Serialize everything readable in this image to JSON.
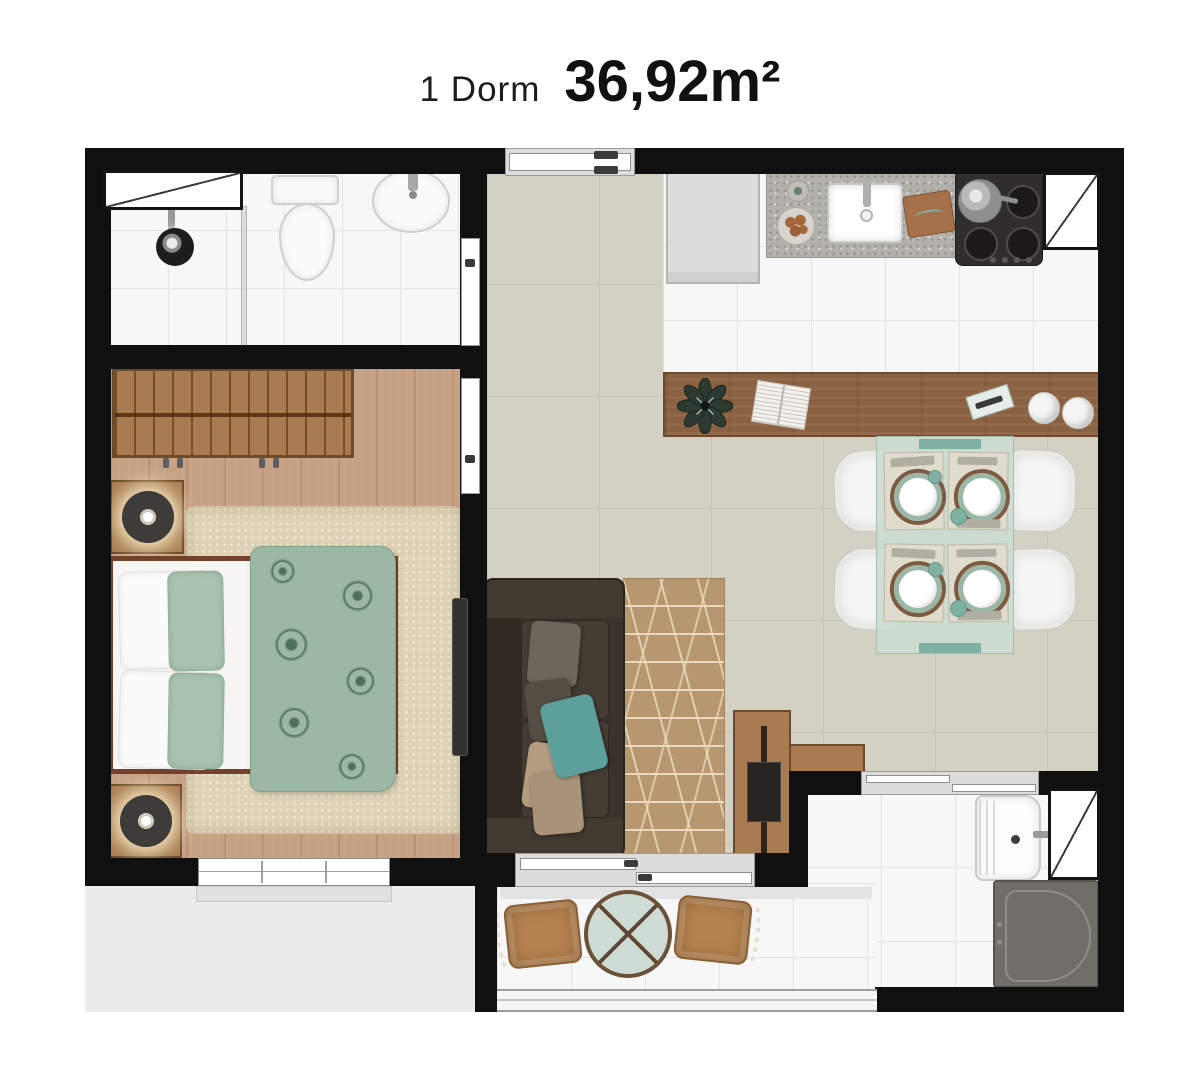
{
  "title": {
    "label": "1 Dorm",
    "area": "36,92m²"
  },
  "floorplan": {
    "unit_type": "1 Dorm",
    "area_label": "36,92m²",
    "colors": {
      "wall": "#101010",
      "tile": "#f7f7f7",
      "grout": "#e3e3e3",
      "concrete": "#d3d0c4",
      "concrete_line": "#c6c3b7",
      "wood_floor": "#c7a183",
      "wood": "#a87c50",
      "wood_dark": "#6e4b28",
      "bar_wood": "#8a6141",
      "duvet_green": "#9cb8a4",
      "accent_teal": "#7fb0a4",
      "sofa": "#3a332b",
      "rug_living": "#b7976f",
      "rug_bedroom": "#ddd2b5",
      "rattan": "#b5824f",
      "appliance_dark": "#2f2e2c",
      "washer_gray": "#6f6e69",
      "glass_green": "#cfdcd3",
      "exterior_gray": "#ececec"
    },
    "rooms": [
      {
        "name": "bathroom",
        "furniture": [
          "window",
          "shower",
          "glass-partition",
          "toilet",
          "washbasin"
        ]
      },
      {
        "name": "bedroom",
        "furniture": [
          "wardrobe",
          "double-bed",
          "floral-duvet",
          "nightstand-lamp-left",
          "nightstand-lamp-right",
          "shag-rug",
          "wall-tv",
          "window"
        ]
      },
      {
        "name": "living-room",
        "furniture": [
          "sofa",
          "area-rug",
          "tv-rack",
          "tv"
        ]
      },
      {
        "name": "kitchen",
        "furniture": [
          "refrigerator",
          "counter-sink",
          "fruit-bowl",
          "cutting-board",
          "cooktop",
          "duct-shaft"
        ]
      },
      {
        "name": "dining",
        "furniture": [
          "bar-counter",
          "plant",
          "book",
          "dining-table",
          "chair-1",
          "chair-2",
          "chair-3",
          "chair-4"
        ]
      },
      {
        "name": "service-area",
        "furniture": [
          "laundry-tank",
          "washing-machine",
          "duct-shaft",
          "sliding-window"
        ]
      },
      {
        "name": "balcony",
        "furniture": [
          "bistro-table",
          "patio-chair-left",
          "patio-chair-right",
          "glass-railing",
          "sliding-door"
        ]
      }
    ]
  }
}
